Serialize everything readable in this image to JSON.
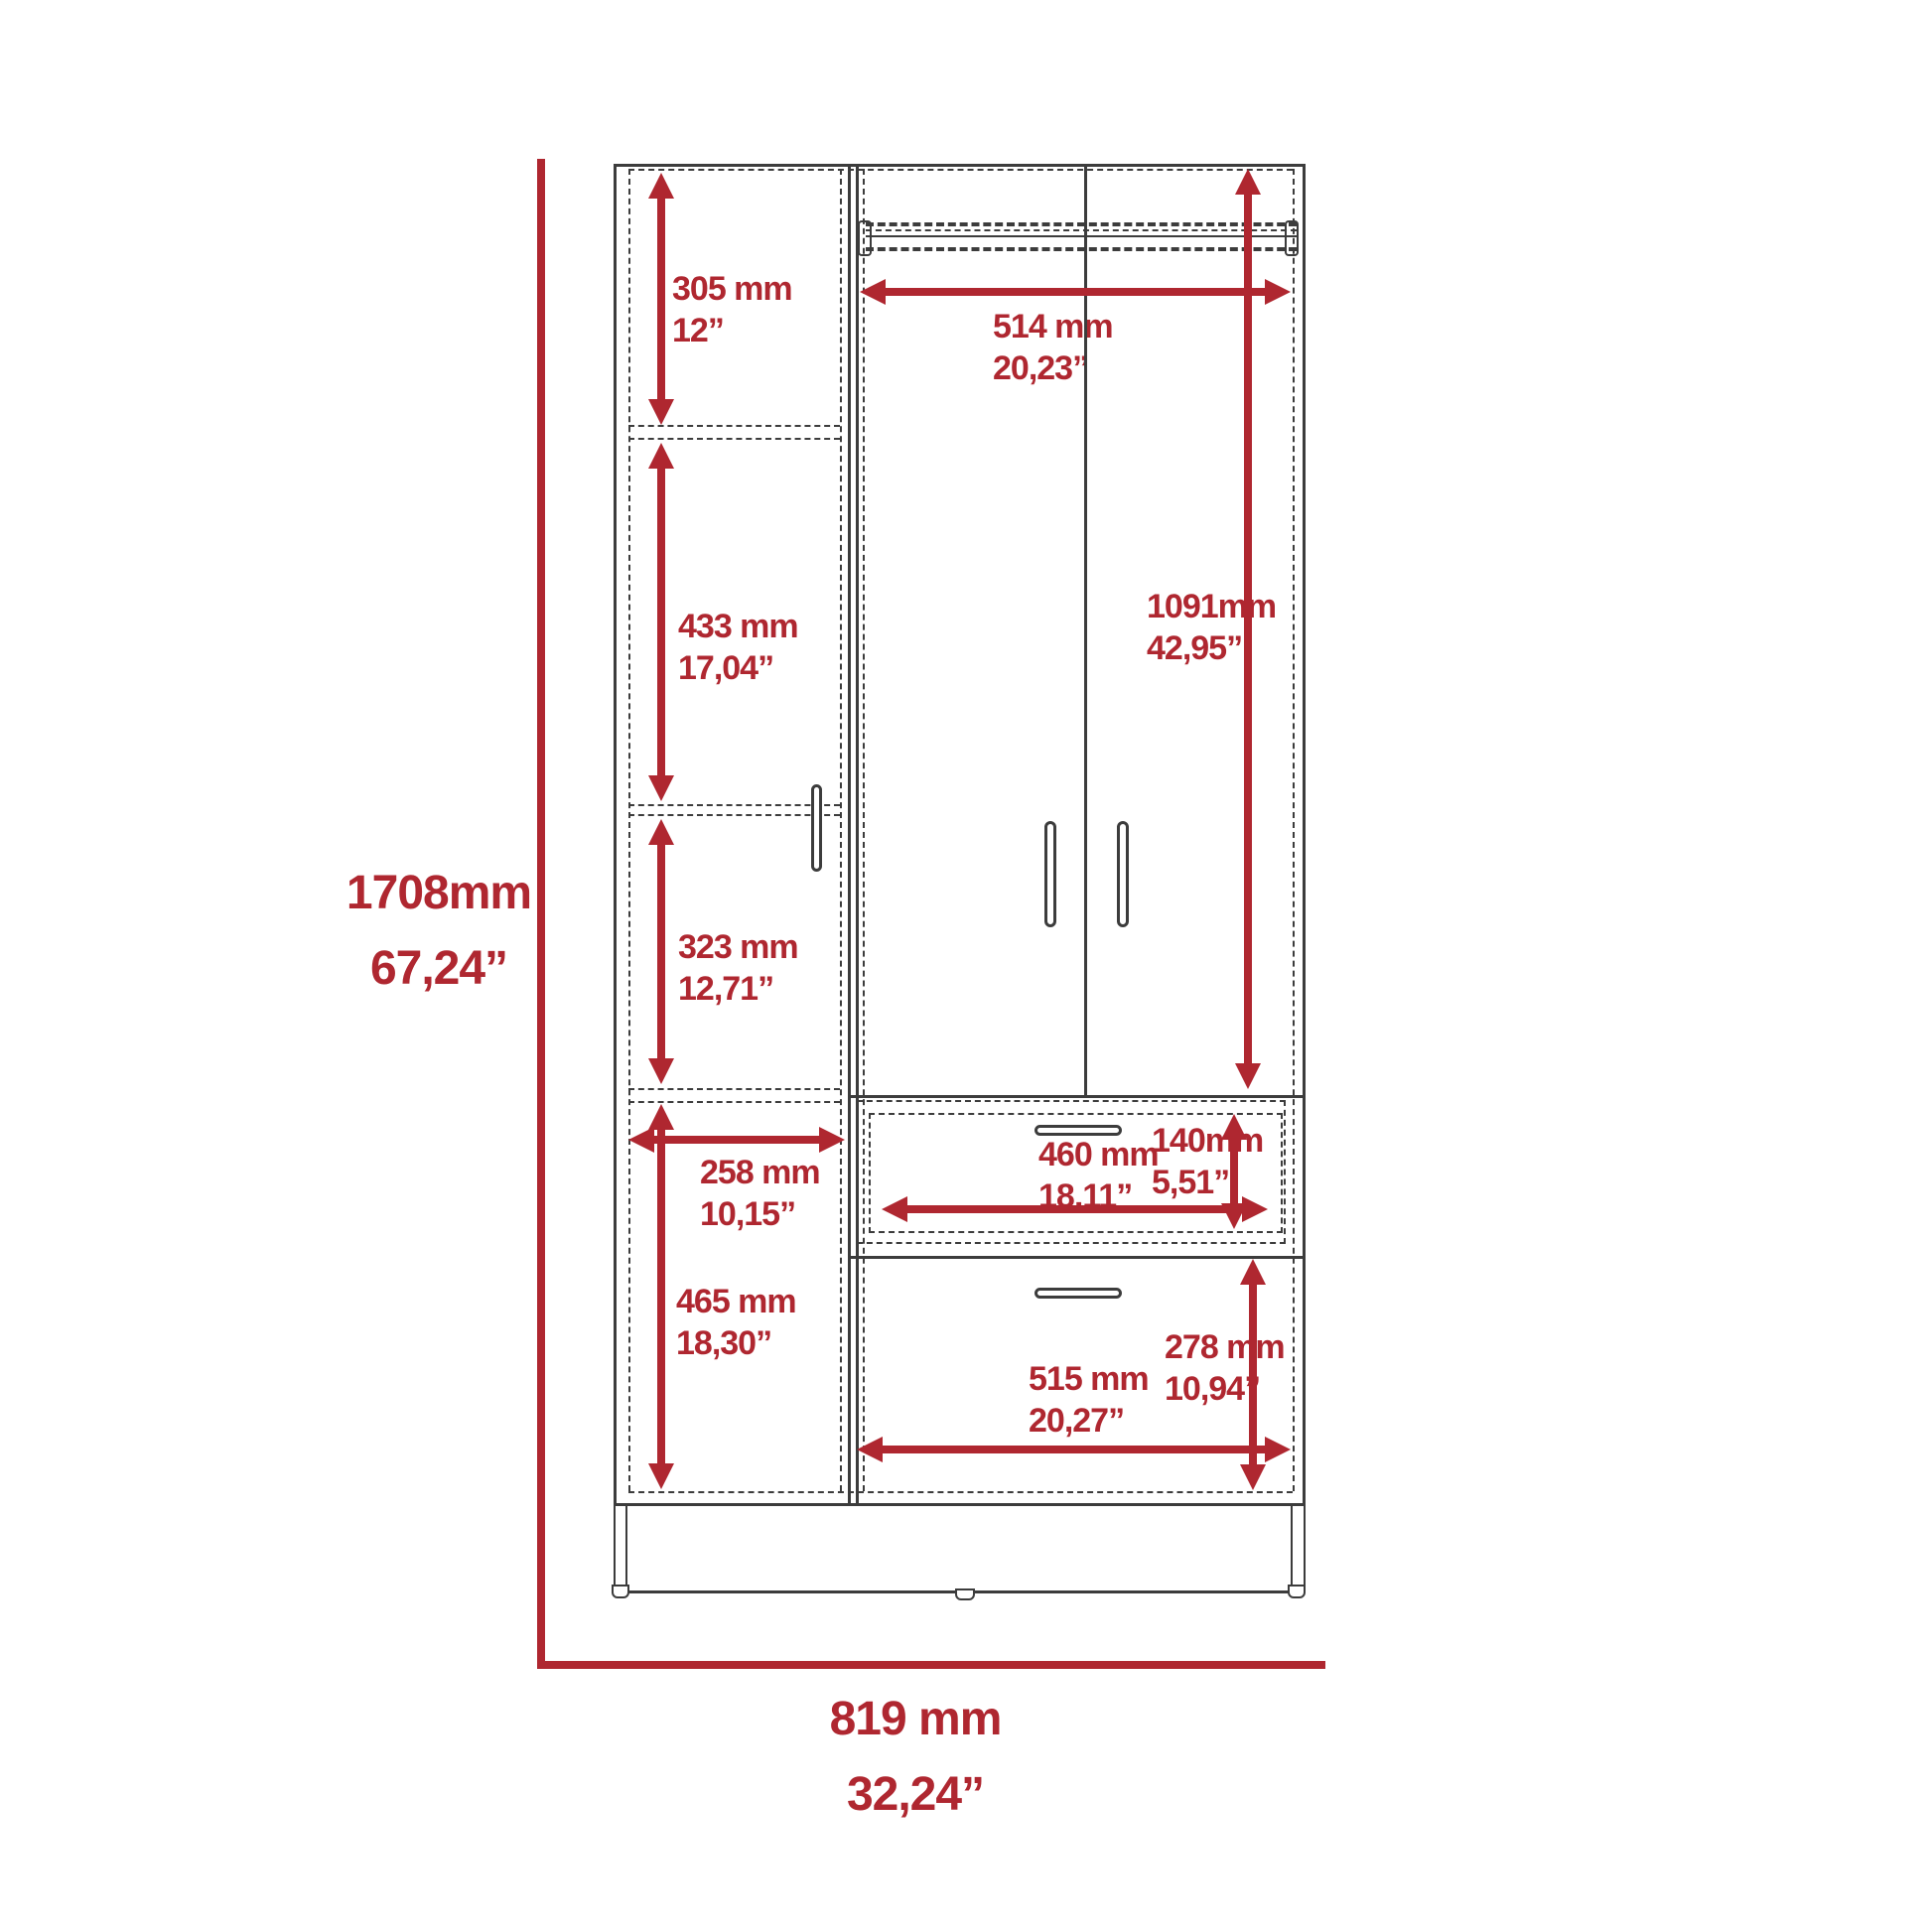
{
  "drawing": {
    "subject": "wardrobe-technical-drawing",
    "colors": {
      "dimension_red": "#AF2730",
      "line_gray": "#3C3C3C",
      "background": "#FFFFFF"
    }
  },
  "dims": {
    "h1708": {
      "mm": "1708mm",
      "in": "67,24”"
    },
    "w819": {
      "mm": "819 mm",
      "in": "32,24”"
    },
    "s305": {
      "mm": "305 mm",
      "in": "12”"
    },
    "s433": {
      "mm": "433 mm",
      "in": "17,04”"
    },
    "s323": {
      "mm": "323 mm",
      "in": "12,71”"
    },
    "s258": {
      "mm": "258 mm",
      "in": "10,15”"
    },
    "s465": {
      "mm": "465 mm",
      "in": "18,30”"
    },
    "w514": {
      "mm": "514 mm",
      "in": "20,23”"
    },
    "h1091": {
      "mm": "1091mm",
      "in": "42,95”"
    },
    "w460": {
      "mm": "460 mm",
      "in": "18,11”"
    },
    "h140": {
      "mm": "140mm",
      "in": "5,51”"
    },
    "w515": {
      "mm": "515 mm",
      "in": "20,27”"
    },
    "h278": {
      "mm": "278 mm",
      "in": "10,94”"
    }
  }
}
